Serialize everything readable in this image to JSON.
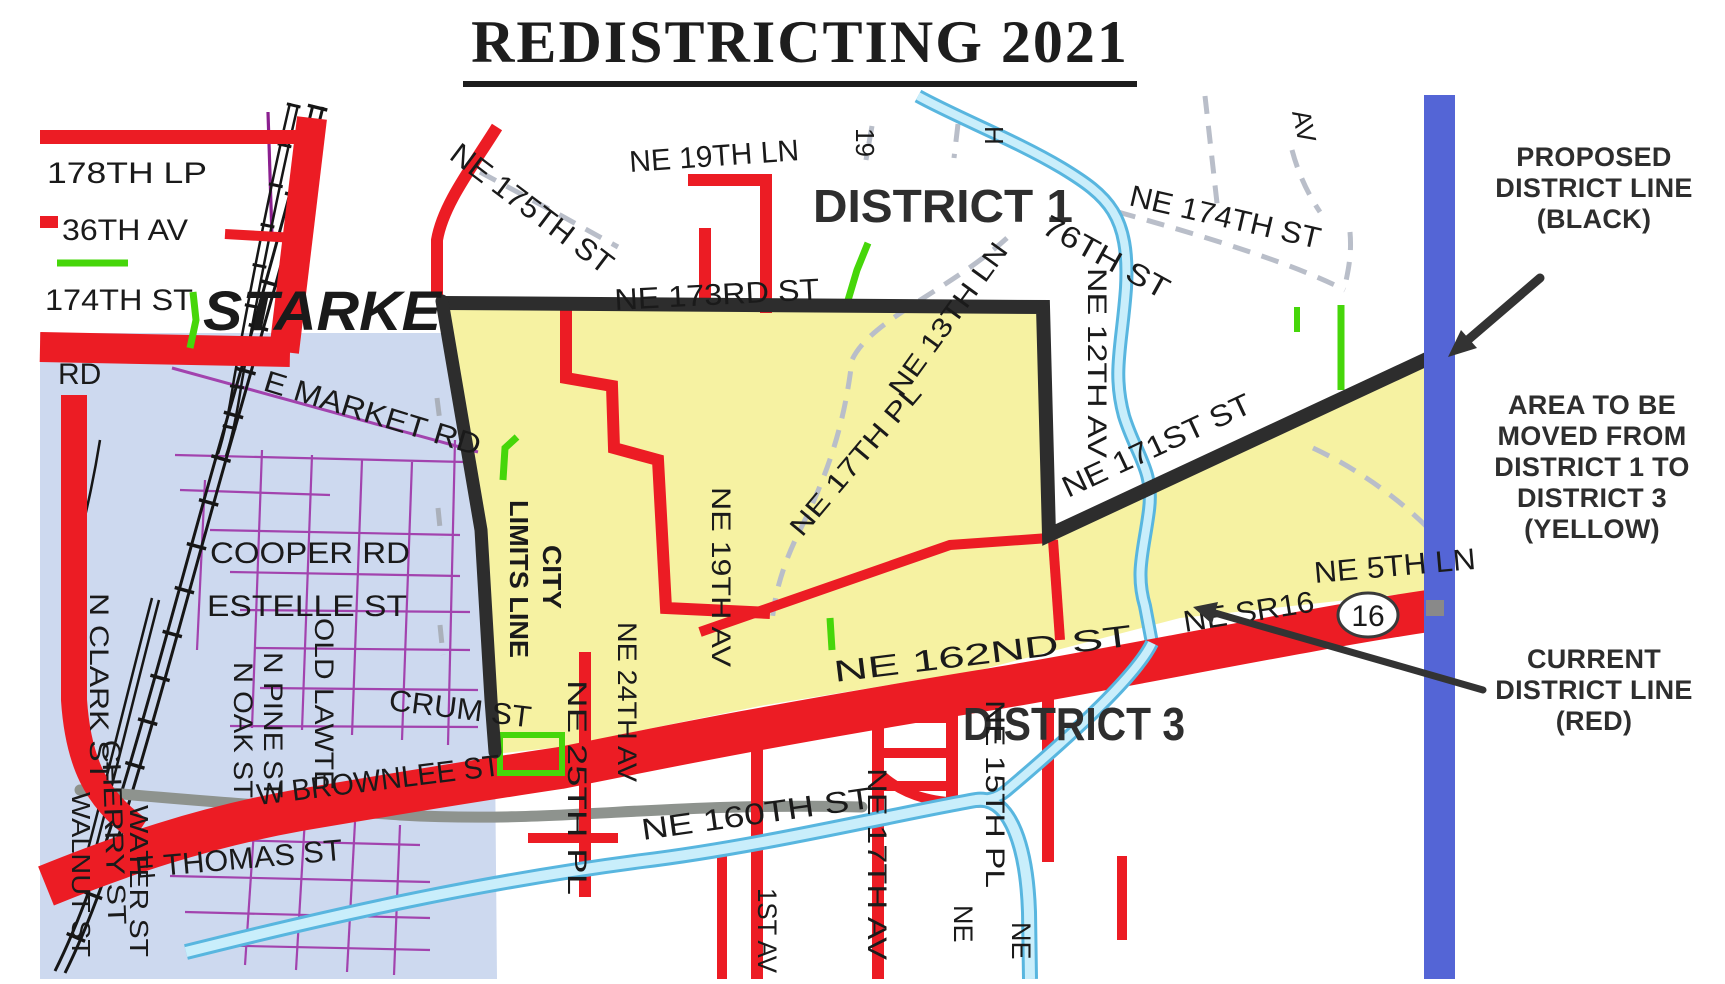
{
  "title": "REDISTRICTING 2021",
  "districts": {
    "district1": "DISTRICT 1",
    "district3": "DISTRICT 3",
    "city_name": "STARKE"
  },
  "annotations": {
    "proposed": {
      "lines": [
        "PROPOSED",
        "DISTRICT LINE",
        "(BLACK)"
      ]
    },
    "area_moved": {
      "lines": [
        "AREA TO BE",
        "MOVED FROM",
        "DISTRICT 1 TO",
        "DISTRICT 3",
        "(YELLOW)"
      ]
    },
    "current": {
      "lines": [
        "CURRENT",
        "DISTRICT LINE",
        "(RED)"
      ]
    }
  },
  "route_shield": {
    "number": "16"
  },
  "streets": {
    "s178th_lp": "178TH LP",
    "s36th_av": "36TH AV",
    "s174th_st": "174TH ST",
    "rd": "RD",
    "ne_175th_st": "NE 175TH ST",
    "ne_19th_ln": "NE 19TH LN",
    "ne_173rd_st": "NE 173RD ST",
    "ne_174th_st": "NE 174TH ST",
    "s76th_st": "76TH ST",
    "ne_13th_ln": "NE 13TH LN",
    "ne_12th_av": "NE 12TH AV",
    "ne_171st_st": "NE 171ST ST",
    "e_market_rd": "E MARKET RD",
    "ne_17th_pl": "NE 17TH PL",
    "cooper_rd": "COOPER RD",
    "estelle_st": "ESTELLE ST",
    "city_limits_line1": "CITY",
    "city_limits_line2": "LIMITS LINE",
    "ne_19th_av": "NE 19TH AV",
    "crum_st": "CRUM ST",
    "ne_24th_av": "NE 24TH AV",
    "ne_25th_pl": "NE 25TH PL",
    "w_brownlee_st": "W BROWNLEE ST",
    "e_thomas_st": "E THOMAS ST",
    "ne_160th_st": "NE 160TH ST",
    "ne_162nd_st": "NE 162ND ST",
    "ne_sr16": "NE SR16",
    "ne_5th_ln": "NE 5TH LN",
    "n_clark_st": "N CLARK ST",
    "walnut_st": "WALNUT ST",
    "cherry_st": "CHERRY ST",
    "water_st": "WATER ST",
    "n_pine_st": "N PINE ST",
    "n_oak_st": "N OAK ST",
    "old_lawtey_rd": "OLD LAWTE",
    "ne_21st_av_frag": "1ST AV",
    "ne_17th_av": "NE 17TH AV",
    "ne_15th_pl": "NE 15TH PL",
    "ne_frag_a": "NE",
    "ne_frag_b": "NE",
    "frag_19": "19",
    "frag_h": "H",
    "frag_av": "AV"
  },
  "colors": {
    "area_yellow": "#f6f2a2",
    "city_blue": "#cdd9ef",
    "proposed_line_black": "#2d2d2d",
    "current_line_red": "#ec1c24",
    "district_line_blue": "#5465d6",
    "creek_blue": "#c9eefb",
    "minor_street_purple": "#a243ae",
    "green_road": "#46d60a",
    "dashed_road_gray": "#b9bec9"
  }
}
